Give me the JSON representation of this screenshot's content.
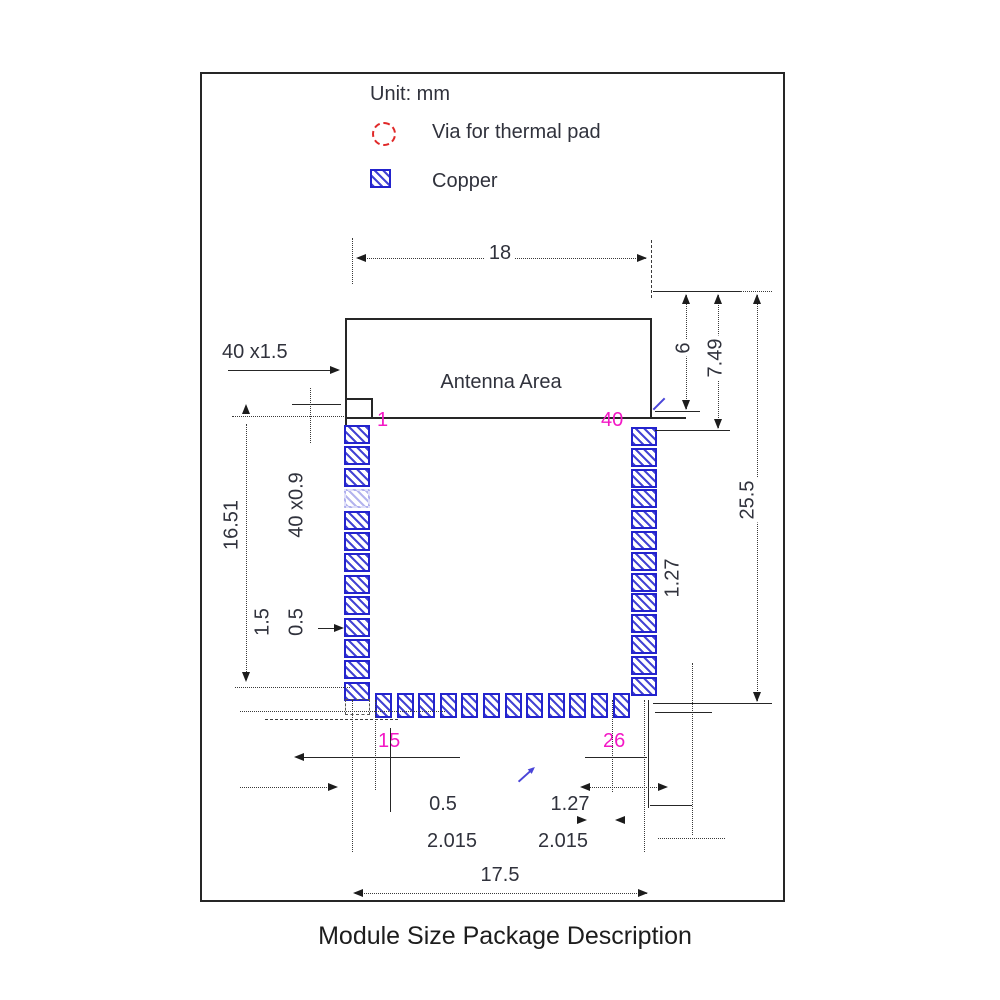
{
  "colors": {
    "line": "#262626",
    "dim_text": "#30323c",
    "copper_blue": "#2323cd",
    "via_red": "#e02828",
    "pin_magenta": "#f318c5"
  },
  "legend": {
    "unit": "Unit: mm",
    "via_label": "Via for thermal pad",
    "copper_label": "Copper",
    "via_icon": "red-dashed-circle",
    "copper_icon": "blue-hatched-square"
  },
  "module": {
    "antenna_area_label": "Antenna Area"
  },
  "dims": {
    "top_width": "18",
    "right_antenna_height": "6",
    "right_749": "7.49",
    "right_total_height": "25.5",
    "right_pad_pitch": "1.27",
    "left_pad_count_len": "40 x1.5",
    "left_1651": "16.51",
    "left_pad_count_w": "40 x0.9",
    "left_15": "1.5",
    "left_05": "0.5",
    "bottom_05": "0.5",
    "bottom_2015_left": "2.015",
    "bottom_127": "1.27",
    "bottom_2015_right": "2.015",
    "bottom_total_width": "17.5"
  },
  "pins": {
    "p1": "1",
    "p40": "40",
    "p15": "15",
    "p26": "26"
  },
  "pads": {
    "left": {
      "count": 13,
      "x": 344,
      "y": 425,
      "w": 22,
      "h": 15,
      "pitch": 21.4,
      "vertical": true,
      "faint_index": 3
    },
    "right": {
      "count": 13,
      "x": 631,
      "y": 427,
      "w": 22,
      "h": 15,
      "pitch": 20.8,
      "vertical": true,
      "faint_index": -1
    },
    "bottom": {
      "count": 12,
      "x": 375,
      "y": 693,
      "w": 13,
      "h": 21,
      "pitch": 21.6,
      "vertical": false,
      "faint_index": -1
    }
  },
  "caption": "Module Size Package Description"
}
